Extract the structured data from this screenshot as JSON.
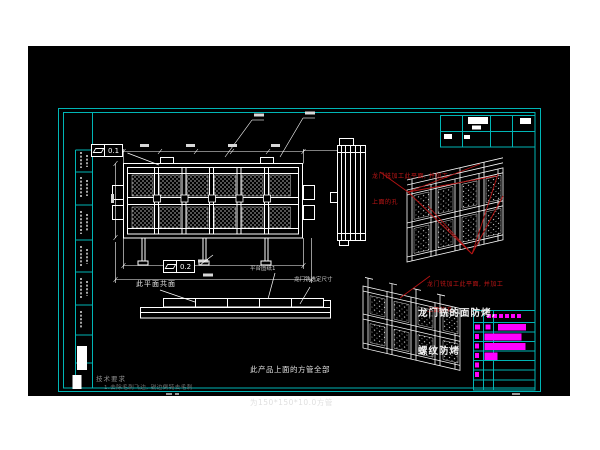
{
  "app": {
    "type": "cad-drawing-viewport"
  },
  "colors": {
    "sheet_frame": "#00b5b5",
    "linework": "#ffffff",
    "annotation_red": "#b51414",
    "detail_magenta": "#ff00ff",
    "dim_text": "#d8d8d8",
    "background": "#000000",
    "page": "#ffffff"
  },
  "gdt": {
    "top": {
      "symbol": "flatness",
      "value": "0.1"
    },
    "mid": {
      "symbol": "flatness",
      "value": "0.2"
    }
  },
  "notes": {
    "red_top_line1": "龙门铣加工此平面, 并加工",
    "red_top_line2": "上面的孔",
    "red_bottom_line1": "龙门铣加工此平面, 并加工",
    "red_bottom_line2": "上面的孔",
    "coplanar": "此平面共面",
    "platform": "平台图纸1",
    "gantry_size": "龙门铣选定尺寸",
    "bake_line1": "龙门铣的面防烤,",
    "bake_line2": "螺纹防烤",
    "tube_line1": "此产品上面的方管全部",
    "tube_line2": "为150*150*10.0方管",
    "tech_title": "技术要求",
    "tech_item": "1.去除毛刺飞边, 锐边倒钝去毛刺"
  }
}
